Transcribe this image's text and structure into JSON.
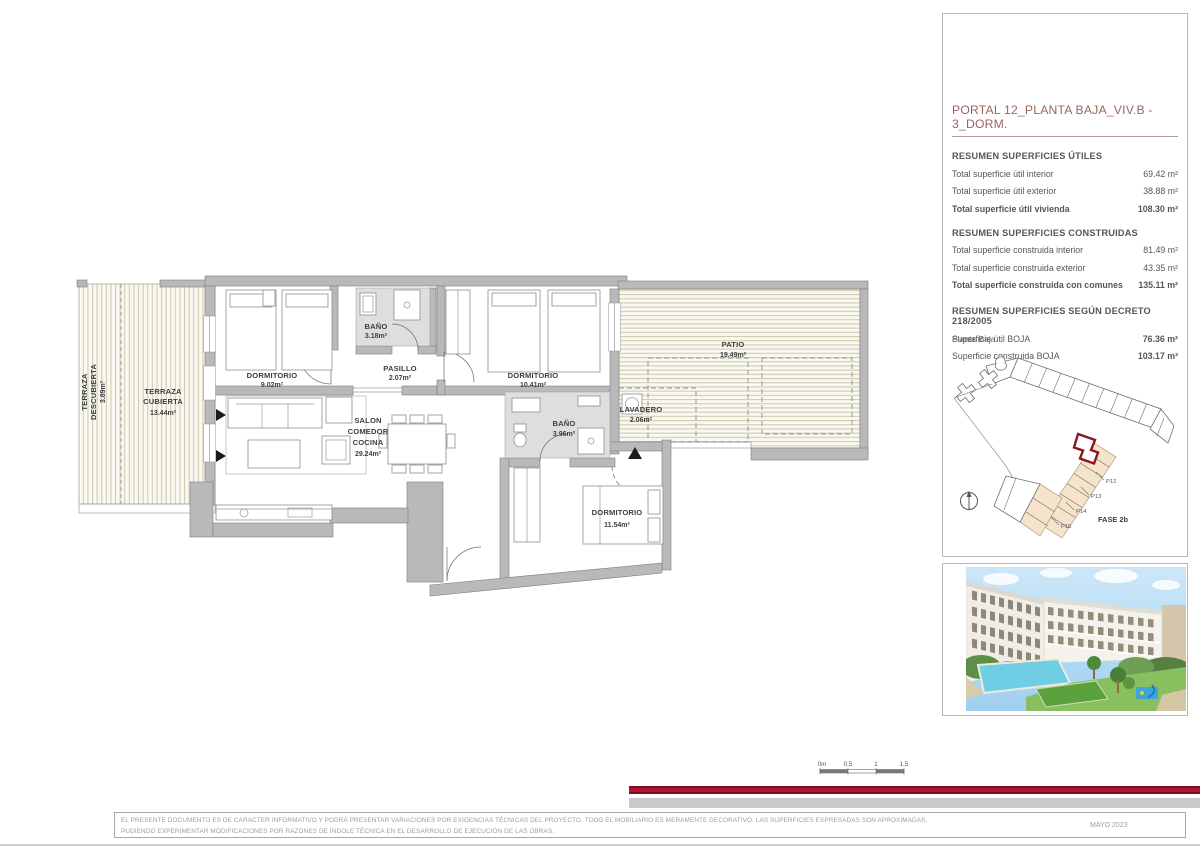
{
  "panel": {
    "title": "PORTAL 12_PLANTA BAJA_VIV.B - 3_DORM.",
    "sections": [
      {
        "heading": "RESUMEN SUPERFICIES ÚTILES",
        "rows": [
          {
            "label": "Total superficie útil interior",
            "value": "69.42 m²"
          },
          {
            "label": "Total superficie útil exterior",
            "value": "38.88 m²"
          },
          {
            "label": "Total superficie útil vivienda",
            "value": "108.30 m²"
          }
        ]
      },
      {
        "heading": "RESUMEN SUPERFICIES CONSTRUIDAS",
        "rows": [
          {
            "label": "Total superficie construida interior",
            "value": "81.49 m²"
          },
          {
            "label": "Total superficie construida exterior",
            "value": "43.35 m²"
          },
          {
            "label": "Total superficie construida con comunes",
            "value": "135.11 m²"
          }
        ]
      },
      {
        "heading": "RESUMEN SUPERFICIES SEGÚN DECRETO 218/2005",
        "rows": [
          {
            "label": "Superficie útil BOJA",
            "value": "76.36 m²"
          },
          {
            "label": "Superficie construida BOJA",
            "value": "103.17 m²"
          }
        ]
      }
    ],
    "siteplan": {
      "caption": "Planta Baja",
      "unit_labels": [
        "P12",
        "P13",
        "P14",
        "P15"
      ],
      "phase_label": "FASE 2b"
    }
  },
  "floorplan": {
    "rooms": {
      "terraza_descubierta": {
        "line1": "TERRAZA",
        "line2": "DESCUBIERTA",
        "area": "3.89m²"
      },
      "terraza_cubierta": {
        "line1": "TERRAZA",
        "line2": "CUBIERTA",
        "area": "13.44m²"
      },
      "dorm1": {
        "name": "DORMITORIO",
        "area": "9.02m²"
      },
      "bano1": {
        "name": "BAÑO",
        "area": "3.18m²"
      },
      "pasillo": {
        "name": "PASILLO",
        "area": "2.07m²"
      },
      "dorm2": {
        "name": "DORMITORIO",
        "area": "10.41m²"
      },
      "patio": {
        "name": "PATIO",
        "area": "19.49m²"
      },
      "lavadero": {
        "name": "LAVADERO",
        "area": "2.06m²"
      },
      "salon": {
        "line1": "SALON",
        "line2": "COMEDOR",
        "line3": "COCINA",
        "area": "29.24m²"
      },
      "bano2": {
        "name": "BAÑO",
        "area": "3.96m²"
      },
      "dorm3": {
        "name": "DORMITORIO",
        "area": "11.54m²"
      }
    }
  },
  "scalebar": {
    "labels": [
      "0m",
      "0,5",
      "1",
      "1,5"
    ]
  },
  "footer": {
    "disclaimer_line1": "EL PRESENTE DOCUMENTO ES DE CARACTER INFORMATIVO Y PODRÁ PRESENTAR VARIACIONES POR EXIGENCIAS TÉCNICAS DEL PROYECTO. TODO EL MOBILIARIO ES MERAMENTE DECORATIVO. LAS SUPERFICIES EXPRESADAS SON APROXIMADAS,",
    "disclaimer_line2": "PUDIENDO EXPERIMENTAR MODIFICACIONES POR RAZONES DE ÍNDOLE TÉCNICA EN EL DESARROLLO DE EJECUCIÓN DE LAS OBRAS.",
    "date": "MAYO 2023"
  },
  "colors": {
    "accent_red_bar": "#b01631",
    "panel_title": "#9c6460",
    "panel_text": "#55565a",
    "wall_gray": "#b9b9b9",
    "site_unit_beige": "#f6e3cb",
    "site_selected_outline": "#8e1420"
  }
}
